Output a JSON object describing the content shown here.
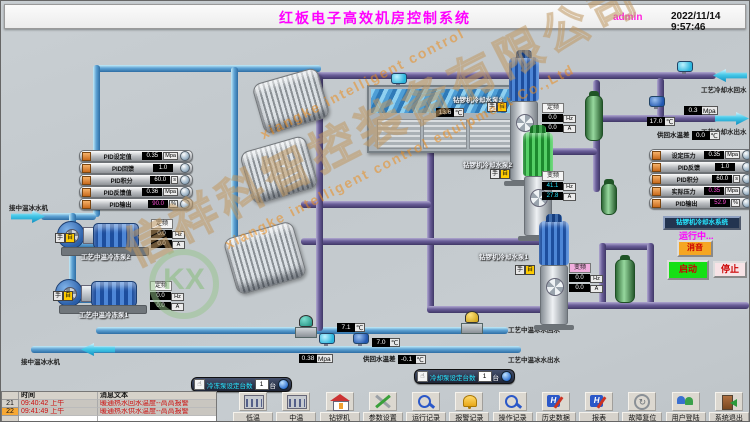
{
  "header": {
    "title": "红板电子高效机房控制系统",
    "user": "admin",
    "datetime": "2022/11/14 9:57:46"
  },
  "watermark": {
    "en1": "xiangke intelligent control",
    "cn": "信祥科智控装备有限公司",
    "en2": "xiangke intelligent control equipment Co.,Ltd",
    "logo": "KX"
  },
  "left_panel": {
    "rows": [
      {
        "label": "PID设定值",
        "value": "0.35",
        "unit": "Mpa"
      },
      {
        "label": "PID回馈",
        "value": "1.0",
        "unit": ""
      },
      {
        "label": "PID积分",
        "value": "60.0",
        "unit": "s"
      },
      {
        "label": "PID反馈值",
        "value": "0.36",
        "unit": "Mpa"
      },
      {
        "label": "PID输出",
        "value": "90.0",
        "unit": "%"
      }
    ]
  },
  "right_panel": {
    "temp_diff": {
      "label": "供回水温差",
      "value": "0.0",
      "unit": "℃"
    },
    "rows": [
      {
        "label": "设定压力",
        "value": "0.35",
        "unit": "Mpa"
      },
      {
        "label": "PID反馈",
        "value": "1.0",
        "unit": ""
      },
      {
        "label": "PID积分",
        "value": "60.0",
        "unit": "s"
      },
      {
        "label": "实际压力",
        "value": "0.35",
        "unit": "Mpa"
      },
      {
        "label": "PID输出",
        "value": "52.9",
        "unit": "%"
      }
    ],
    "system_button": "钻锣机冷却水系统",
    "status": "运行中...",
    "mute_button": "消音",
    "start_button": "启动",
    "stop_button": "停止"
  },
  "pipe_labels": {
    "inlet_top": "接中温冰水机",
    "inlet_bottom": "接中温冰水机",
    "cooling_return": "工艺冷却水回水",
    "cooling_supply": "工艺冷却水出水",
    "chilled_return": "工艺中温冰水回水",
    "chilled_supply": "工艺中温冰水出水"
  },
  "readings": {
    "tank_temp": {
      "value": "13.6",
      "unit": "℃"
    },
    "supply_temp_right": {
      "value": "17.0",
      "unit": "℃"
    },
    "supply_press_right": {
      "value": "0.3",
      "unit": "Mpa"
    },
    "return_temp": {
      "value": "7.1",
      "unit": "℃"
    },
    "supply_temp": {
      "value": "7.0",
      "unit": "℃"
    },
    "supply_press": {
      "value": "0.38",
      "unit": "Mpa"
    },
    "temp_diff": {
      "label": "供回水温差",
      "value": "-0.1",
      "unit": "℃"
    }
  },
  "pumps": {
    "hand": "手",
    "auto": "自",
    "hp2": {
      "name": "工艺中温冷冻泵2",
      "mode": "定频",
      "hz": "0.0",
      "hz_unit": "Hz",
      "amp": "0.0",
      "amp_unit": "A"
    },
    "hp1": {
      "name": "工艺中温冷冻泵1",
      "mode": "定频",
      "hz": "0.0",
      "hz_unit": "Hz",
      "amp": "0.0",
      "amp_unit": "A"
    },
    "vp3": {
      "name": "钻锣机冷却水泵3",
      "mode": "定频",
      "hz": "0.0",
      "hz_unit": "Hz",
      "amp": "0.0",
      "amp_unit": "A"
    },
    "vp2": {
      "name": "钻锣机冷却水泵2",
      "mode": "变频",
      "hz": "41.1",
      "hz_unit": "Hz",
      "amp": "27.8",
      "amp_unit": "A"
    },
    "vp1": {
      "name": "钻锣机冷却水泵1",
      "mode": "变频",
      "hz": "0.0",
      "hz_unit": "Hz",
      "amp": "0.0",
      "amp_unit": "A"
    }
  },
  "setters": {
    "chilled": {
      "label": "冷冻泵设定台数",
      "value": "1",
      "unit": "台"
    },
    "cooling": {
      "label": "冷却泵设定台数",
      "value": "1",
      "unit": "台"
    }
  },
  "alarm_table": {
    "col_time": "时间",
    "col_msg": "消息文本",
    "rows": [
      {
        "no": "21",
        "time": "09:40:42 上午",
        "msg": "暖通热水回水温度--高高报警"
      },
      {
        "no": "22",
        "time": "09:41:49 上午",
        "msg": "暖通热水供水温度--高高报警"
      }
    ]
  },
  "nav": {
    "items": [
      {
        "label": "低温"
      },
      {
        "label": "中温"
      },
      {
        "label": "钻锣机"
      },
      {
        "label": "参数设置"
      },
      {
        "label": "运行记录"
      },
      {
        "label": "报警记录"
      },
      {
        "label": "操作记录"
      },
      {
        "label": "历史数据"
      },
      {
        "label": "报表"
      },
      {
        "label": "故障复位"
      },
      {
        "label": "用户登陆"
      },
      {
        "label": "系统退出"
      }
    ]
  }
}
